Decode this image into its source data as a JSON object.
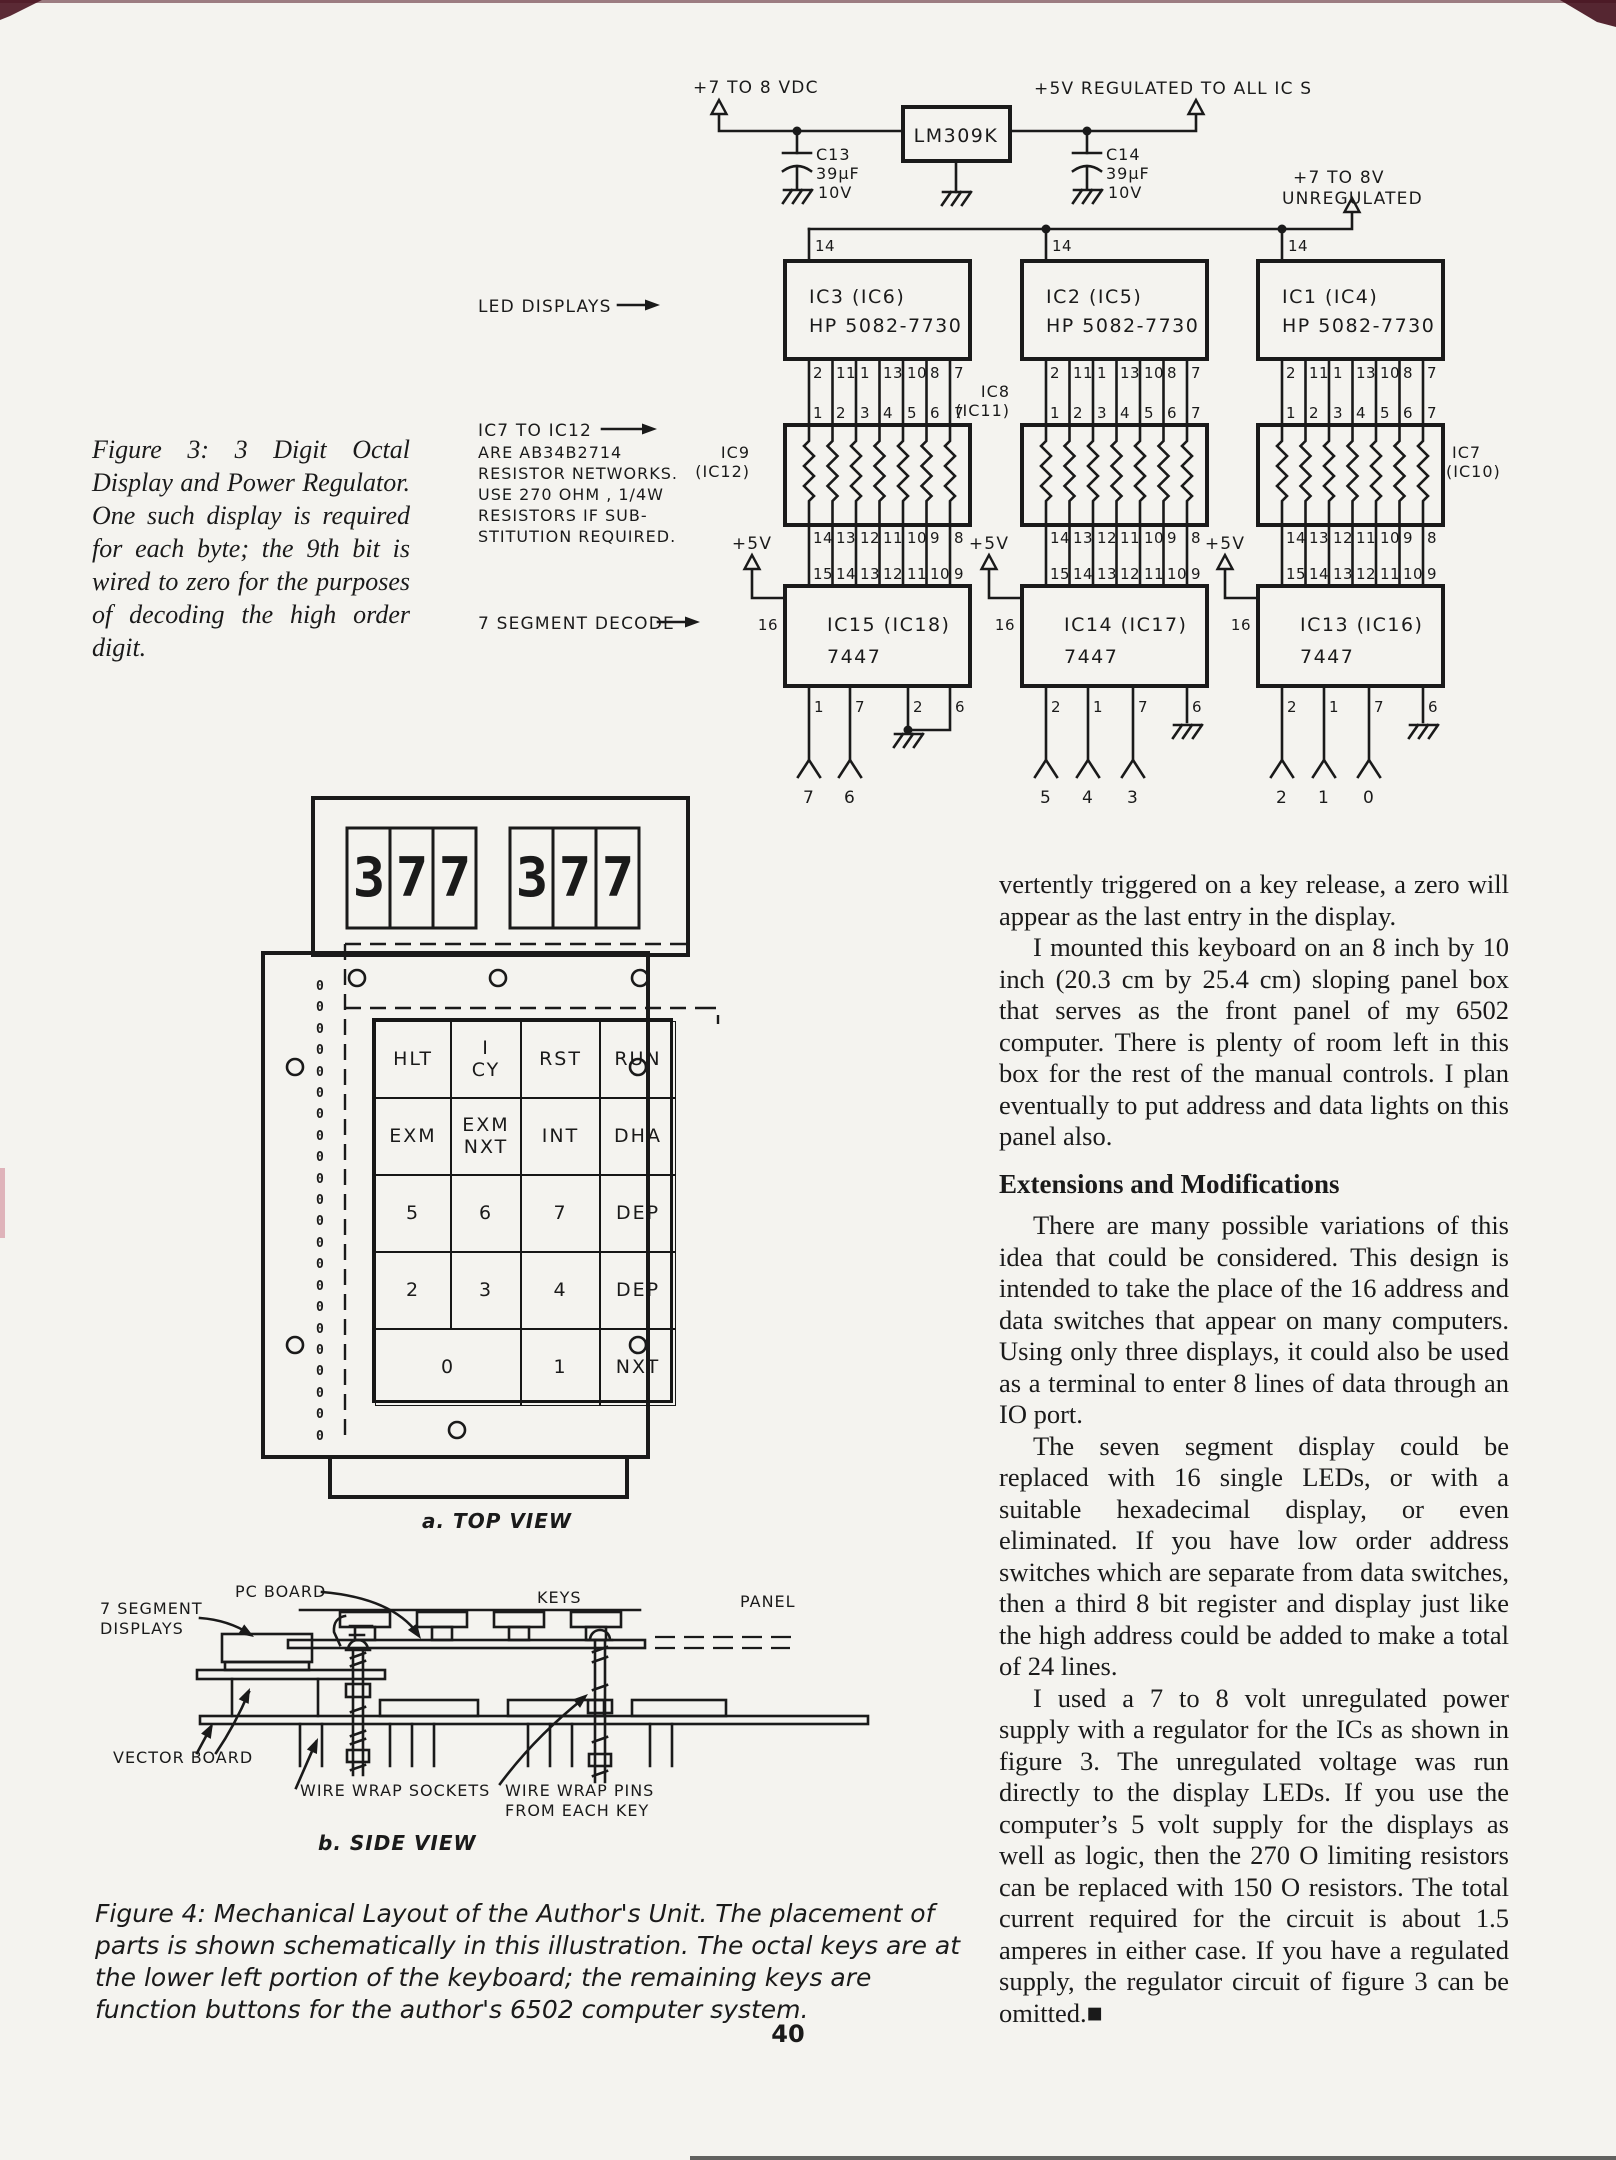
{
  "page": {
    "number": "40"
  },
  "figure3": {
    "caption": "Figure 3: 3 Digit Octal Display and Power Regulator. One such display is required for each byte; the 9th bit is wired to zero for the purposes of decoding the high order digit.",
    "power": {
      "input": "+7 TO 8 VDC",
      "regulator": "LM309K",
      "c13": {
        "name": "C13",
        "value": "39μF",
        "volts": "10V"
      },
      "c14": {
        "name": "C14",
        "value": "39μF",
        "volts": "10V"
      },
      "regulated": "+5V REGULATED TO ALL IC S",
      "unreg1": "+7 TO 8V",
      "unreg2": "UNREGULATED"
    },
    "notes": {
      "led": "LED DISPLAYS",
      "r1": "IC7 TO IC12",
      "r2": "ARE AB34B2714",
      "r3": "RESISTOR NETWORKS.",
      "r4": "USE 270 OHM , 1/4W",
      "r5": "RESISTORS IF SUB-",
      "r6": "STITUTION REQUIRED.",
      "decode": "7 SEGMENT DECODE"
    },
    "pins": {
      "display_out": [
        "2",
        "11",
        "1",
        "13",
        "10",
        "8",
        "7"
      ],
      "network_in": [
        "1",
        "2",
        "3",
        "4",
        "5",
        "6",
        "7"
      ],
      "network_out": [
        "14",
        "13",
        "12",
        "11",
        "10",
        "9",
        "8"
      ],
      "decoder_in": [
        "15",
        "14",
        "13",
        "12",
        "11",
        "10",
        "9"
      ],
      "vcc": "14",
      "enable": "16",
      "plus5": "+5V"
    },
    "columns": [
      {
        "display": "IC3 (IC6)",
        "part": "HP 5082-7730",
        "net1": "IC9",
        "net2": "(IC12)",
        "decoder": "IC15 (IC18)",
        "dpart": "7447",
        "out": [
          "1",
          "7",
          "2",
          "6"
        ],
        "sig": [
          "7",
          "6"
        ]
      },
      {
        "display": "IC2 (IC5)",
        "part": "HP 5082-7730",
        "net1": "IC8",
        "net2": "(IC11)",
        "decoder": "IC14 (IC17)",
        "dpart": "7447",
        "out": [
          "2",
          "1",
          "7",
          "6"
        ],
        "sig": [
          "5",
          "4",
          "3"
        ]
      },
      {
        "display": "IC1 (IC4)",
        "part": "HP 5082-7730",
        "net1": "IC7",
        "net2": "(IC10)",
        "decoder": "IC13 (IC16)",
        "dpart": "7447",
        "out": [
          "2",
          "1",
          "7",
          "6"
        ],
        "sig": [
          "2",
          "1",
          "0"
        ]
      }
    ]
  },
  "figure4": {
    "caption": "Figure 4: Mechanical Layout of the Author's Unit. The placement of parts is shown schematically in this illustration. The octal keys are at the lower left portion of the keyboard; the remaining keys are function buttons for the author's 6502 computer system.",
    "top_label": "a. TOP VIEW",
    "side_label": "b. SIDE VIEW",
    "digits": [
      "3",
      "7",
      "7",
      "3",
      "7",
      "7"
    ],
    "holes": "0\n0\n0\n0\n0\n0\n0\n0\n0\n0\n0\n0\n0\n0\n0\n0\n0\n0\n0\n0\n0\n0",
    "keys": [
      {
        "label": "HLT"
      },
      {
        "label": "I\nCY"
      },
      {
        "label": "RST"
      },
      {
        "label": "RUN"
      },
      {
        "label": "EXM"
      },
      {
        "label": "EXM\nNXT"
      },
      {
        "label": "INT"
      },
      {
        "label": "DHA"
      },
      {
        "label": "5"
      },
      {
        "label": "6"
      },
      {
        "label": "7"
      },
      {
        "label": "DEP"
      },
      {
        "label": "2"
      },
      {
        "label": "3"
      },
      {
        "label": "4"
      },
      {
        "label": "DEP"
      },
      {
        "label": "0"
      },
      {
        "label": "1"
      },
      {
        "label": "NXT"
      }
    ],
    "side": {
      "pc_board": "PC BOARD",
      "seg1": "7 SEGMENT",
      "seg2": "DISPLAYS",
      "keys": "KEYS",
      "panel": "PANEL",
      "vector": "VECTOR BOARD",
      "sockets": "WIRE WRAP SOCKETS",
      "pins1": "WIRE WRAP PINS",
      "pins2": "FROM EACH KEY"
    }
  },
  "article": {
    "p1": "vertently triggered on a key release, a zero will appear as the last entry in the display.",
    "p2": "I mounted this keyboard on an 8 inch by 10 inch (20.3 cm by 25.4 cm) sloping panel box that serves as the front panel of my 6502 computer. There is plenty of room left in this box for the rest of the manual controls. I plan eventually to put address and data lights on this panel also.",
    "heading": "Extensions and Modifications",
    "p3": "There are many possible variations of this idea that could be considered. This design is intended to take the place of the 16 address and data switches that appear on many computers. Using only three displays, it could also be used as a terminal to enter 8 lines of data through an IO port.",
    "p4": "The seven segment display could be replaced with 16 single LEDs, or with a suitable hexadecimal display, or even eliminated. If you have low order address switches which are separate from data switches, then a third 8 bit register and display just like the high address could be added to make a total of 24 lines.",
    "p5": "I used a 7 to 8 volt unregulated power supply with a regulator for the ICs as shown in figure 3. The unregulated voltage was run directly to the display LEDs. If you use the computer’s 5 volt supply for the displays as well as logic, then the 270 O limiting resistors can be replaced with 150 O resistors. The total current required for the circuit is about 1.5 amperes in either case. If you have a regulated supply, the regulator circuit of figure 3 can be omitted.■"
  }
}
